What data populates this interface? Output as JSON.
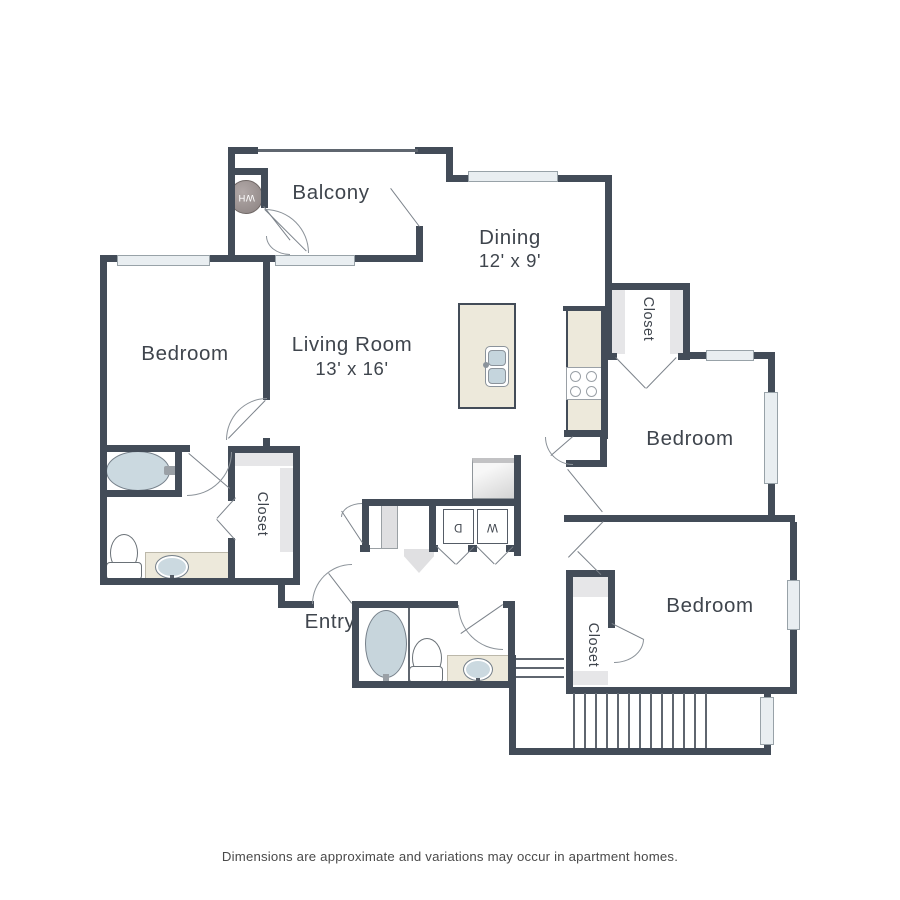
{
  "colors": {
    "wall": "#434c58",
    "window_fill": "#e9eef1",
    "counter_cream": "#ede9db",
    "fixture_blue": "#cbd9e0",
    "water_heater_gray": "#978e8d",
    "label_text": "#3f454d"
  },
  "rooms": {
    "balcony": {
      "label": "Balcony"
    },
    "dining": {
      "label": "Dining",
      "dimensions": "12' x 9'"
    },
    "living": {
      "label": "Living Room",
      "dimensions": "13' x 16'"
    },
    "bedroom_left": {
      "label": "Bedroom"
    },
    "bedroom_right": {
      "label": "Bedroom"
    },
    "bedroom_bottom": {
      "label": "Bedroom"
    },
    "entry": {
      "label": "Entry"
    }
  },
  "closets": {
    "upper_right": "Closet",
    "left": "Closet",
    "bottom": "Closet"
  },
  "appliances": {
    "water_heater": "WH",
    "washer": "W",
    "dryer": "D"
  },
  "footer": {
    "disclaimer": "Dimensions are approximate and variations may occur in apartment homes."
  }
}
